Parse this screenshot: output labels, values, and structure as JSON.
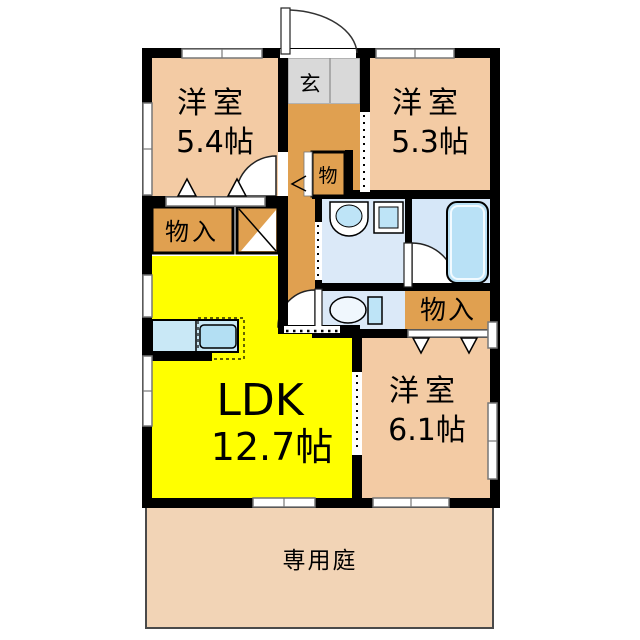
{
  "floor_plan": {
    "rooms": {
      "bedroom_nw": {
        "type": "洋室",
        "size": "5.4帖"
      },
      "bedroom_ne": {
        "type": "洋室",
        "size": "5.3帖"
      },
      "bedroom_se": {
        "type": "洋室",
        "size": "6.1帖"
      },
      "ldk": {
        "type": "LDK",
        "size": "12.7帖"
      },
      "entrance": {
        "label": "玄"
      },
      "garden": {
        "label": "専用庭"
      }
    },
    "storage": {
      "west": {
        "label": "物入"
      },
      "hall": {
        "label": "物"
      },
      "east": {
        "label": "物入"
      }
    }
  },
  "colors": {
    "wall": "#000000",
    "room-peach": "#F3CBA4",
    "garden-peach": "#F2D4B6",
    "hall-orange": "#E0A050",
    "ldk-yellow": "#FFFF00",
    "entrance-gray": "#D9D9D9",
    "wet-blue": "#DBE9F8",
    "bath-blue": "#D6E7F8",
    "fixture-blue": "#BEE4F7",
    "tub-blue": "#B9E1F6",
    "counter-blue": "#C9E8F6",
    "sink-blue": "#B3DFF3",
    "window-gray": "#777777"
  }
}
